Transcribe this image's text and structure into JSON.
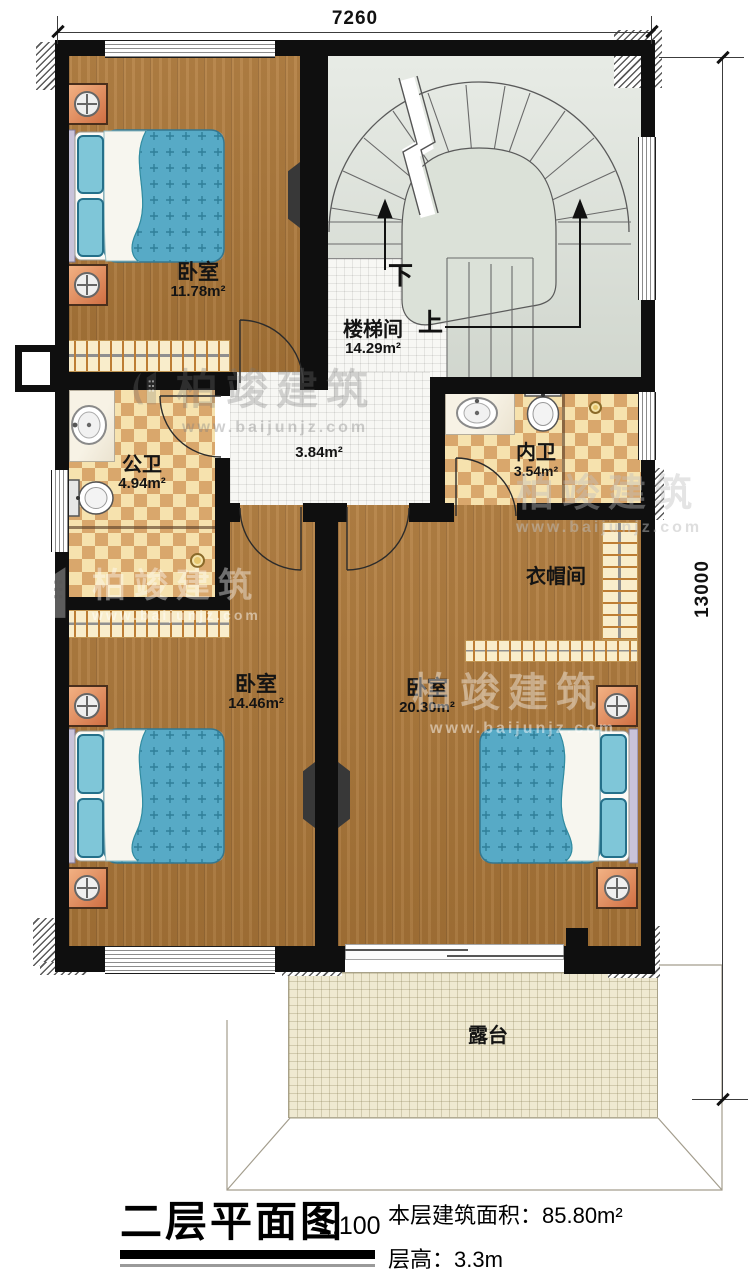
{
  "dimensions": {
    "width_top": "7260",
    "height_right": "13000"
  },
  "rooms": {
    "bedroom_top": {
      "name": "卧室",
      "area": "11.78m²"
    },
    "stairwell": {
      "name": "楼梯间",
      "area": "14.29m²"
    },
    "hall": {
      "area": "3.84m²"
    },
    "bath_public": {
      "name": "公卫",
      "area": "4.94m²"
    },
    "bath_inner": {
      "name": "内卫",
      "area": "3.54m²"
    },
    "cloakroom": {
      "name": "衣帽间"
    },
    "bedroom_left": {
      "name": "卧室",
      "area": "14.46m²"
    },
    "bedroom_right": {
      "name": "卧室",
      "area": "20.30m²"
    },
    "terrace": {
      "name": "露台"
    }
  },
  "stairs": {
    "down_label": "下",
    "up_label": "上"
  },
  "title_block": {
    "title": "二层平面图",
    "scale": "1:100",
    "floor_area": "本层建筑面积：85.80m²",
    "floor_height": "层高：3.3m"
  },
  "watermark": {
    "brand": "柏竣建筑",
    "url": "www.baijunjz.com"
  },
  "colors": {
    "wall": "#0f0f0f",
    "wood_floor": "#b07a3a",
    "stair_floor": "#dbe1d8",
    "tile_light": "#f6e2ae",
    "tile_dark": "#d9a76c",
    "terrace": "#efe9d1",
    "bed_quilt": "#57aac6",
    "nightstand": "#d06f43"
  }
}
